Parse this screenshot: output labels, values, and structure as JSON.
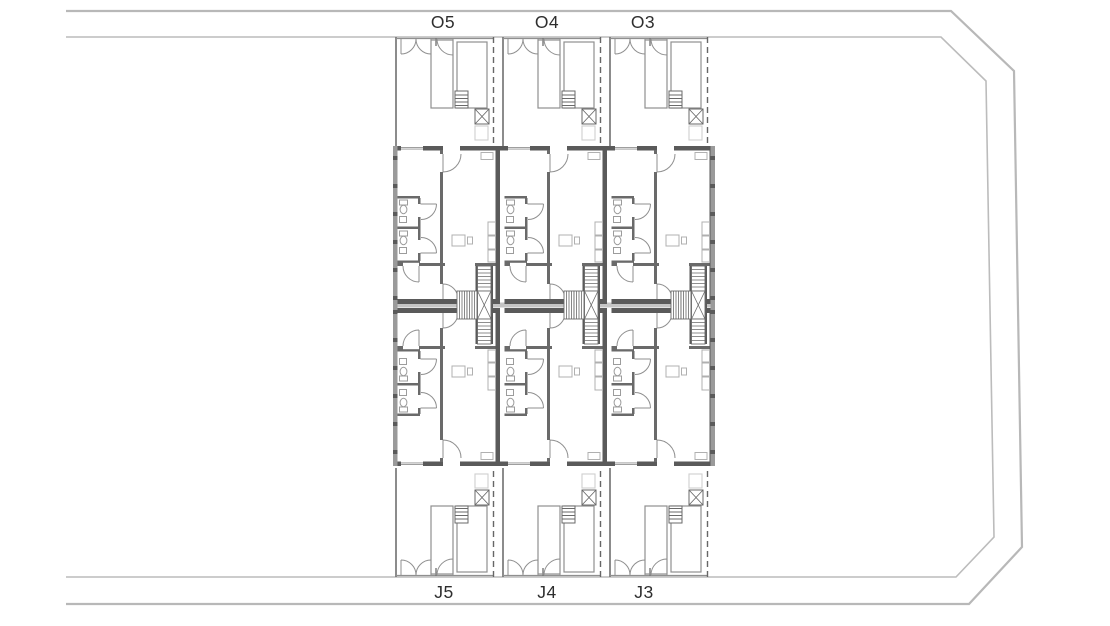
{
  "drawing": {
    "type": "architectural-site-floor-plan",
    "background": "#ffffff",
    "colors": {
      "site_boundary": "#b8b8b8",
      "exterior_walls": "#5a5a5a",
      "partitions": "#8f8f8f",
      "fixtures": "#9c9c9c",
      "furniture": "#b0b0b0",
      "gallery_band": "#c4c4c4",
      "stair_lines": "#6a6a6a",
      "labels": "#2e2e2e"
    },
    "upper_units": [
      {
        "label": "O5"
      },
      {
        "label": "O4"
      },
      {
        "label": "O3"
      }
    ],
    "lower_units": [
      {
        "label": "J5"
      },
      {
        "label": "J4"
      },
      {
        "label": "J3"
      }
    ]
  }
}
